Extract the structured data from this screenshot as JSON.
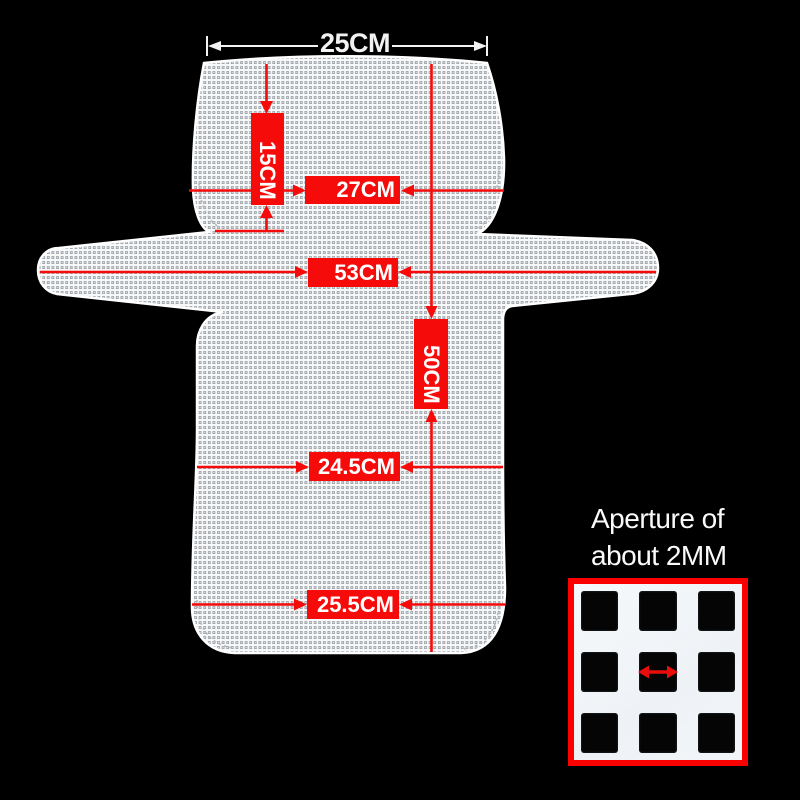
{
  "colors": {
    "background": "#000000",
    "accent-red": "#f60b0b",
    "inset-border-red": "#fc0000",
    "mesh-base": "#f7f8f9",
    "white-dim": "#f2f2f2"
  },
  "measurements": {
    "top_width": "25CM",
    "headrest_height": "15CM",
    "headrest_width": "27CM",
    "wing_span": "53CM",
    "overall_height": "50CM",
    "seat_mid_width": "24.5CM",
    "seat_bottom_width": "25.5CM"
  },
  "aperture_note": {
    "line1": "Aperture of",
    "line2": "about 2MM"
  }
}
